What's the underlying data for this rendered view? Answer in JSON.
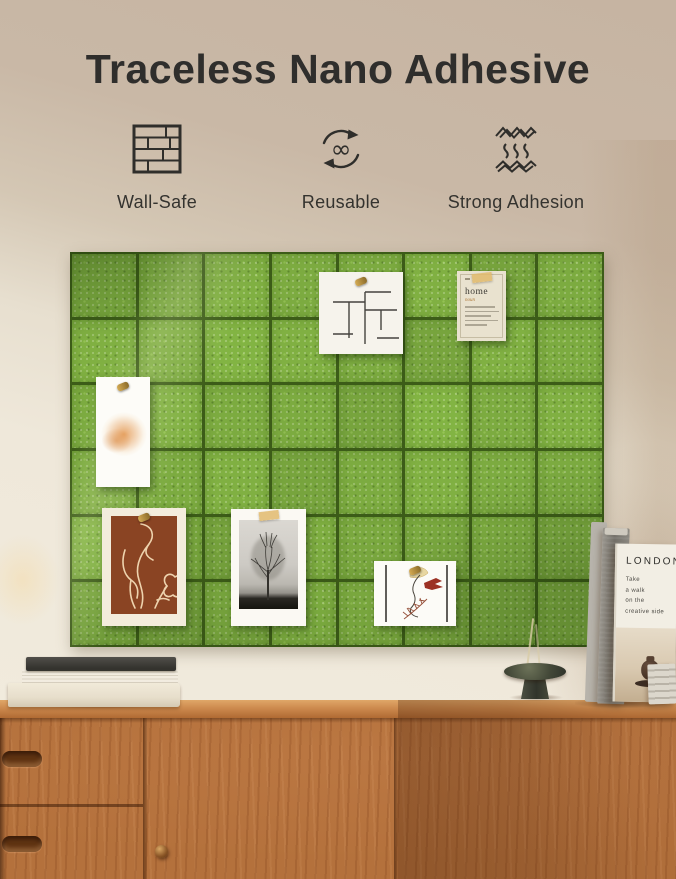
{
  "title": "Traceless Nano Adhesive",
  "features": [
    {
      "label": "Wall-Safe"
    },
    {
      "label": "Reusable"
    },
    {
      "label": "Strong Adhesion"
    }
  ],
  "board": {
    "cols": 8,
    "rows": 6,
    "tile_color": "#7cab40",
    "seam_color": "#3c5c18"
  },
  "cards": {
    "home_card": {
      "word": "home",
      "part_of_speech": "noun"
    }
  },
  "london_book": {
    "title": "LONDON",
    "subtitle": "Take\na walk\non the\ncreative side"
  },
  "colors": {
    "wall_top": "#c8b6a4",
    "wall_bottom": "#f0e9db",
    "felt_green": "#7cab40",
    "wood": "#b4713c",
    "title_text": "#2f2e2c"
  }
}
